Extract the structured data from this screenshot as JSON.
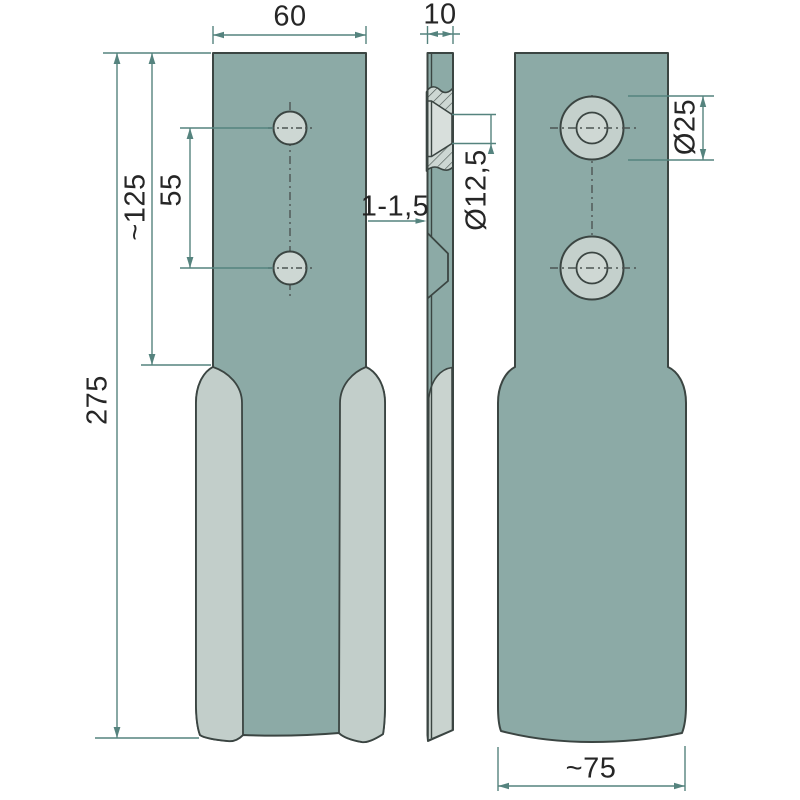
{
  "drawing": {
    "title": "blade-three-view-technical-drawing",
    "labels": {
      "width_top": "60",
      "thickness": "10",
      "length_total": "275",
      "length_upper": "~125",
      "hole_spacing": "55",
      "edge_thickness": "1-1,5",
      "hole_diameter": "Ø12,5",
      "counterbore_diameter": "Ø25",
      "width_bottom": "~75"
    },
    "colors": {
      "face_teal": "#8caaa6",
      "bevel_light": "#c2cecа",
      "hole_fill": "#cdd7d3",
      "outline": "#3b4542",
      "dimension_line": "#55837e",
      "text": "#262626",
      "background": "#ffffff"
    }
  }
}
